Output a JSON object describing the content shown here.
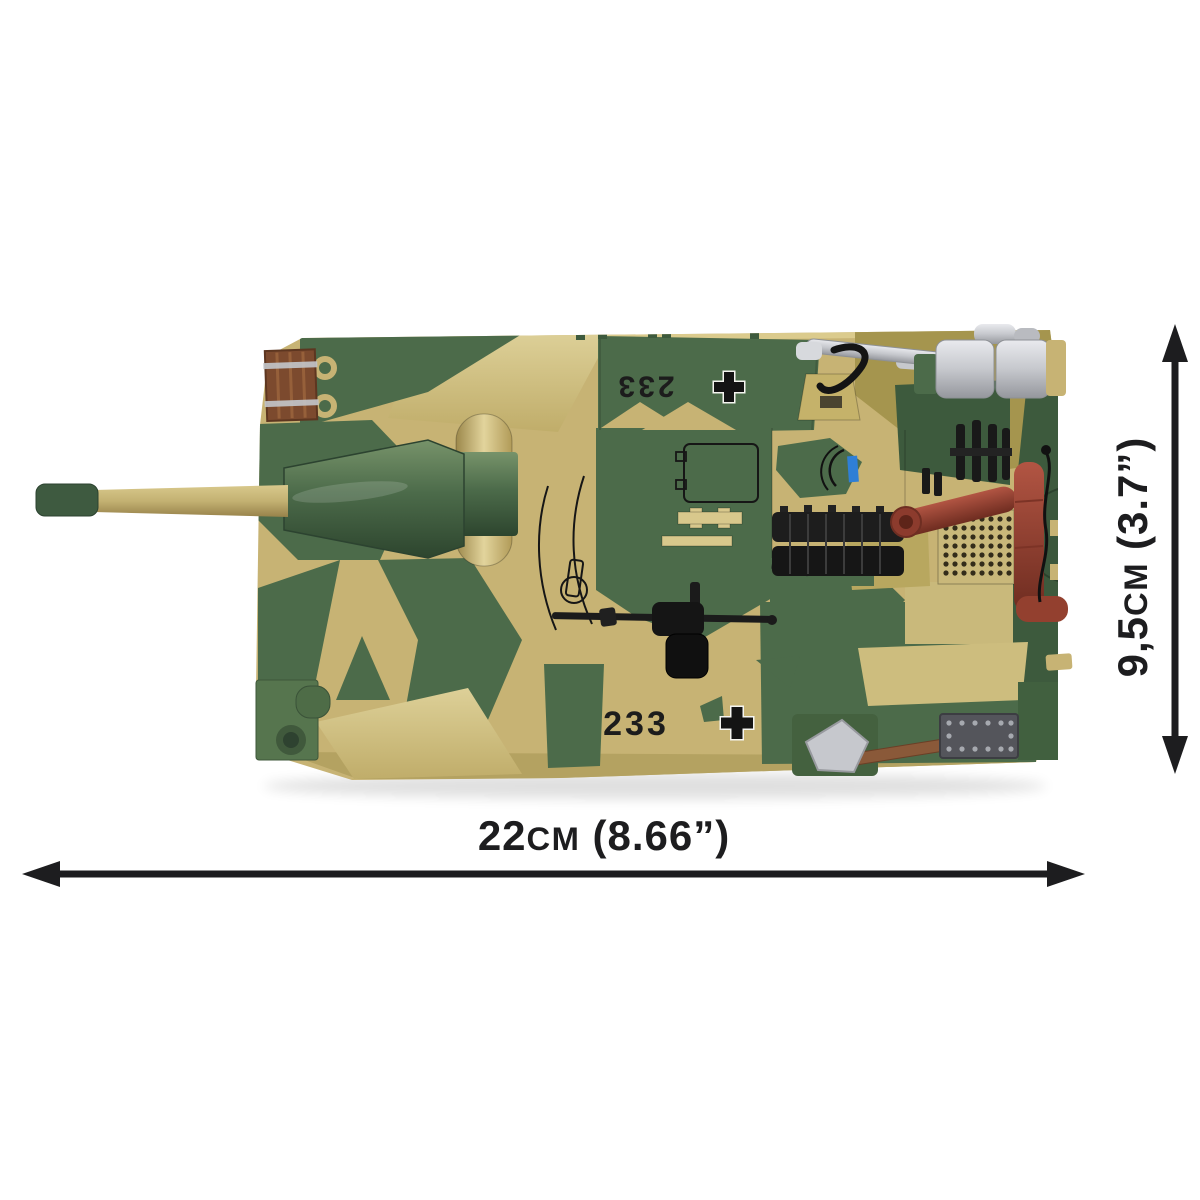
{
  "product": {
    "name": "Brick-built tank model, top view with size specifications",
    "view": "top"
  },
  "markings": {
    "tactical_number": "233",
    "insignia": "balkenkreuz-cross"
  },
  "dimensions": {
    "width": {
      "value": "22",
      "unit": "cm",
      "imperial": "(8.66”)",
      "label": "22cm (8.66”)"
    },
    "height": {
      "value": "9,5",
      "unit": "cm",
      "imperial": "(3.7”)",
      "label": "9,5cm (3.7”)"
    }
  },
  "colors": {
    "camo_tan": "#c7b374",
    "camo_tan_light": "#d8c88c",
    "camo_olive": "#a5954e",
    "camo_green": "#4c6b4a",
    "camo_dark_green": "#3d5a3d",
    "crate_brown": "#7c4a2e",
    "exhaust_rust": "#9e4433",
    "metal_silver": "#c6c8cd",
    "track_black": "#1d1d1d",
    "periscope_blue": "#2f7fd6",
    "dimension_ink": "#1d1d1f"
  }
}
